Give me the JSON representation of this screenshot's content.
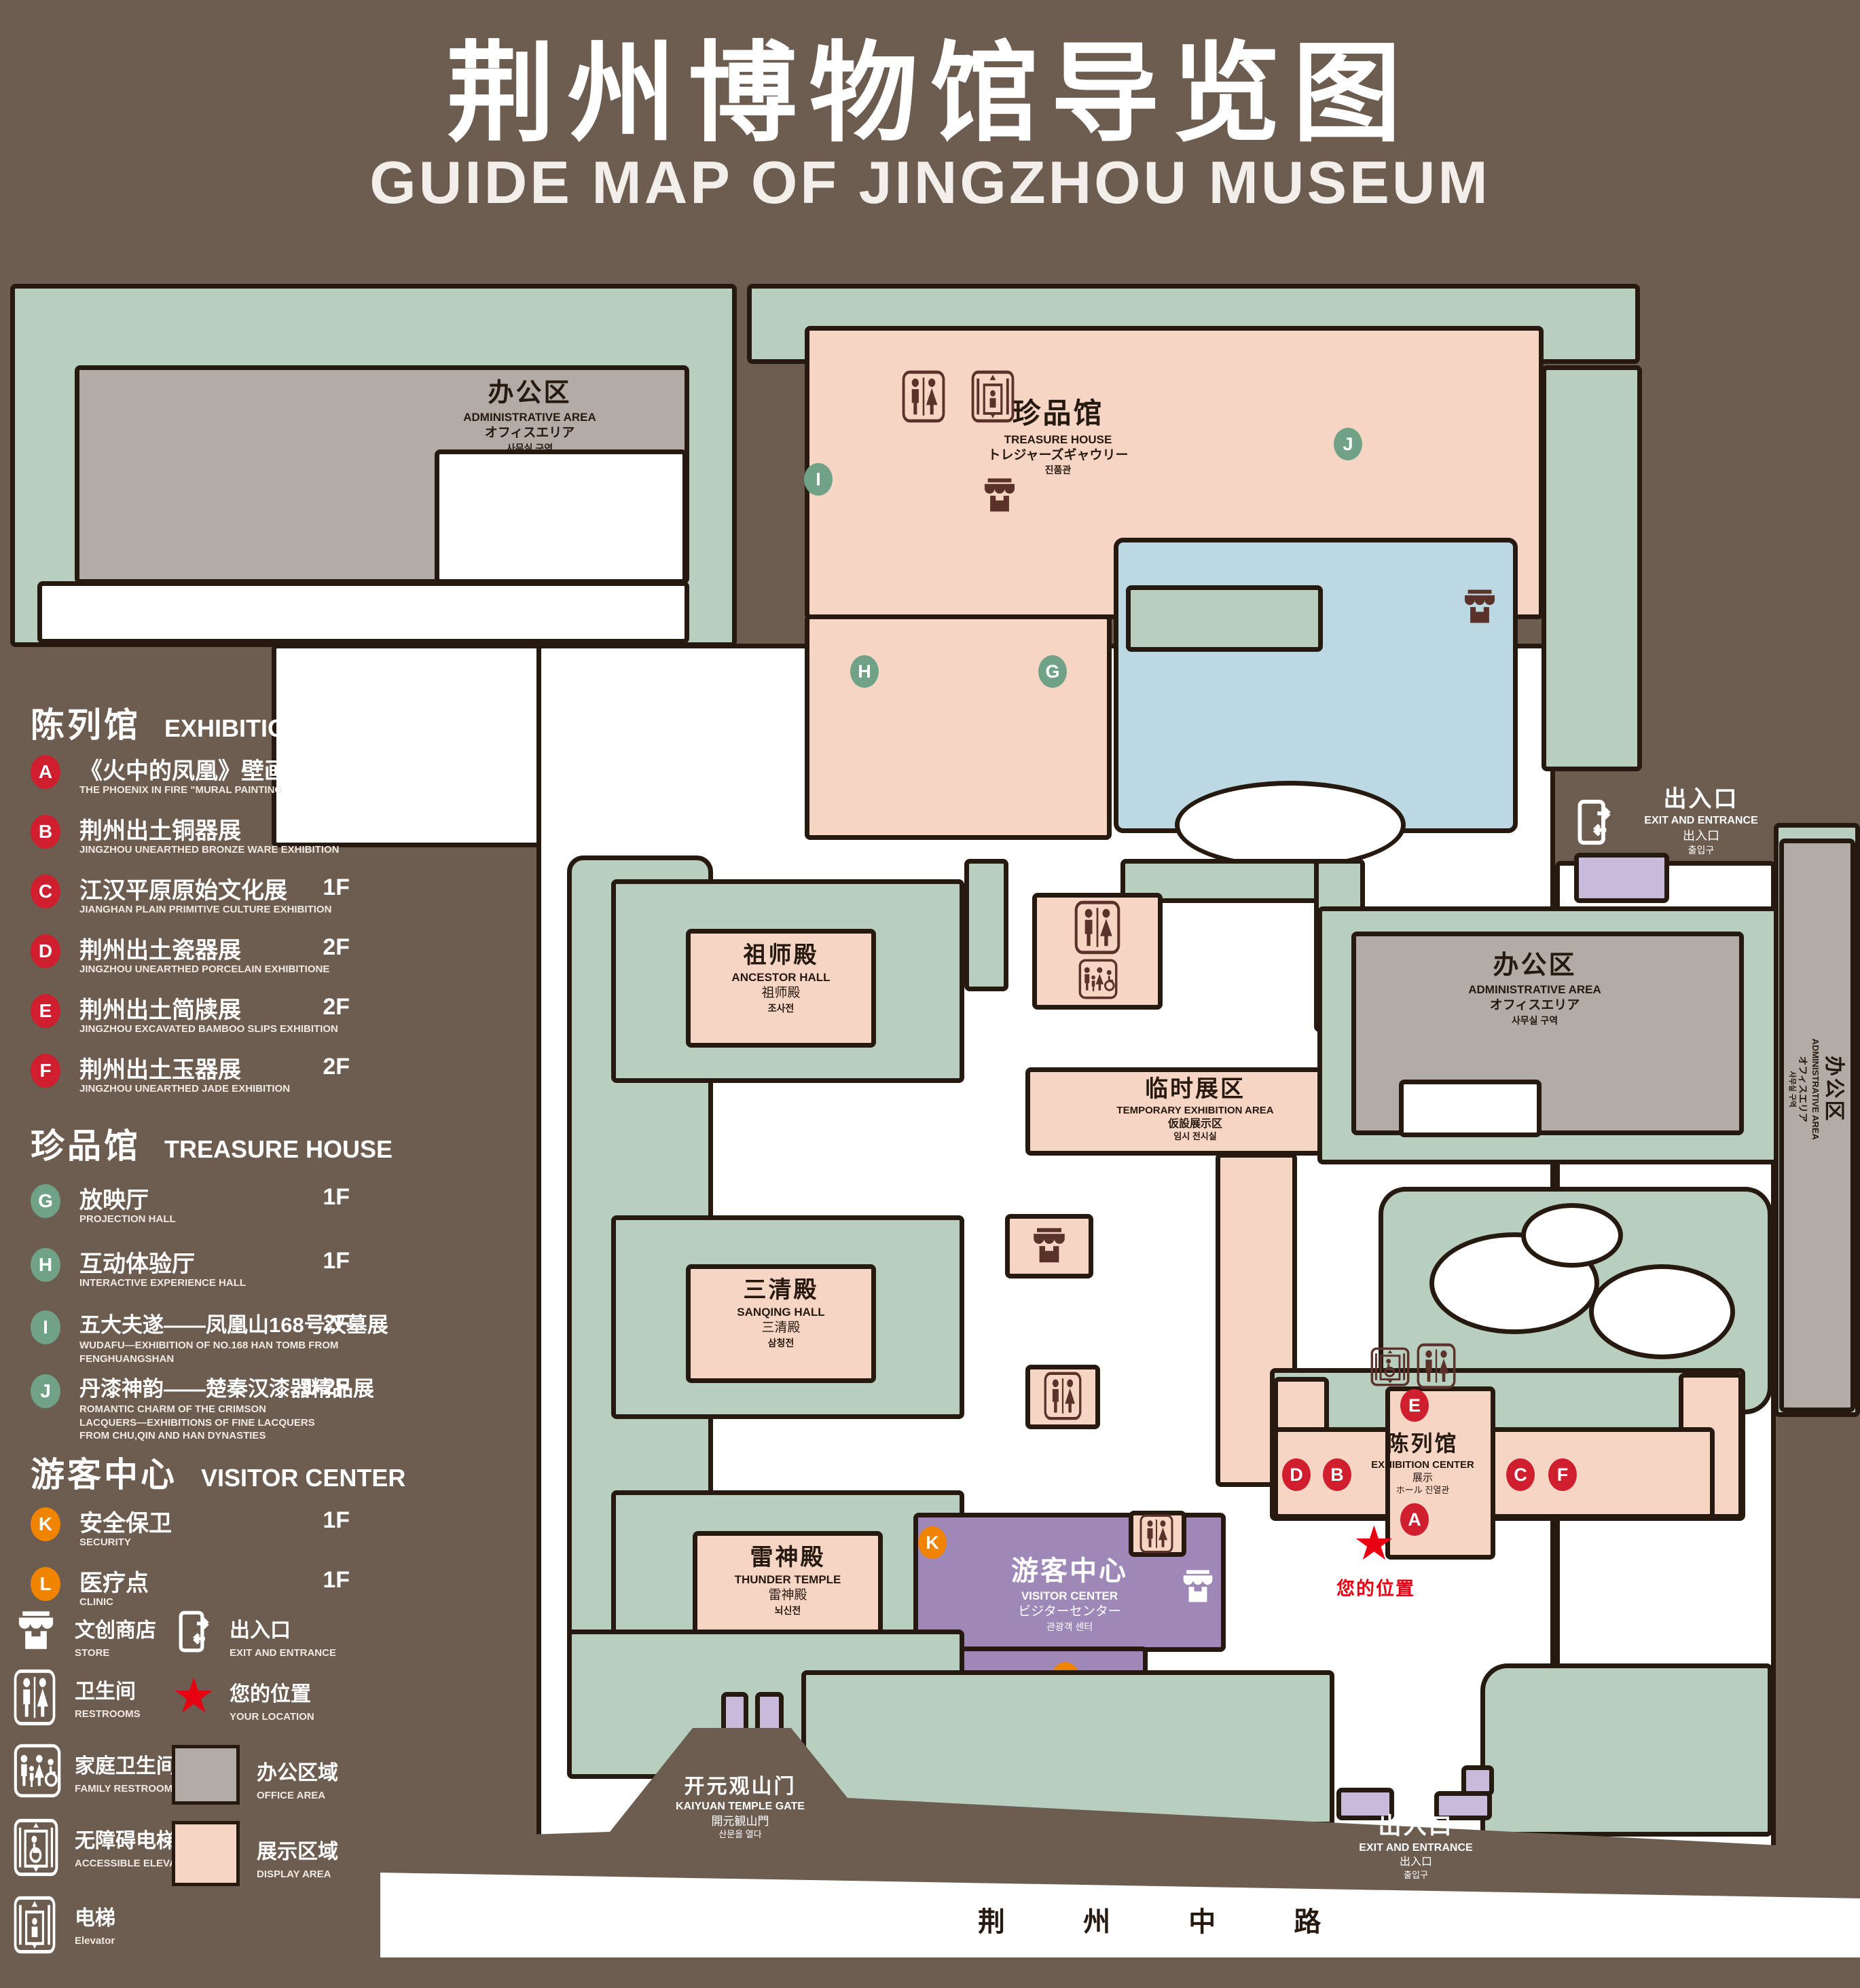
{
  "title": {
    "cn": "荆州博物馆导览图",
    "en": "GUIDE MAP OF JINGZHOU MUSEUM"
  },
  "legend": {
    "sections": [
      {
        "cn": "陈列馆",
        "en": "EXHIBITION CENTER",
        "items": [
          {
            "k": "A",
            "cn": "《火中的凤凰》壁画",
            "en": "THE PHOENIX IN FIRE \"MURAL PAINTING",
            "fl": "1F"
          },
          {
            "k": "B",
            "cn": "荆州出土铜器展",
            "en": "JINGZHOU UNEARTHED BRONZE WARE EXHIBITION",
            "fl": "1F"
          },
          {
            "k": "C",
            "cn": "江汉平原原始文化展",
            "en": "JIANGHAN PLAIN PRIMITIVE CULTURE EXHIBITION",
            "fl": "1F"
          },
          {
            "k": "D",
            "cn": "荆州出土瓷器展",
            "en": "JINGZHOU UNEARTHED PORCELAIN EXHIBITIONE",
            "fl": "2F"
          },
          {
            "k": "E",
            "cn": "荆州出土简牍展",
            "en": "JINGZHOU EXCAVATED BAMBOO SLIPS EXHIBITION",
            "fl": "2F"
          },
          {
            "k": "F",
            "cn": "荆州出土玉器展",
            "en": "JINGZHOU UNEARTHED JADE EXHIBITION",
            "fl": "2F"
          }
        ]
      },
      {
        "cn": "珍品馆",
        "en": "TREASURE HOUSE",
        "items": [
          {
            "k": "G",
            "cn": "放映厅",
            "en": "PROJECTION HALL",
            "fl": "1F"
          },
          {
            "k": "H",
            "cn": "互动体验厅",
            "en": "INTERACTIVE EXPERIENCE HALL",
            "fl": "1F"
          },
          {
            "k": "I",
            "cn": "五大夫遂——凤凰山168号汉墓展",
            "en": "WUDAFU—EXHIBITION OF NO.168 HAN TOMB FROM FENGHUANGSHAN",
            "fl": "2F"
          },
          {
            "k": "J",
            "cn": "丹漆神韵——楚秦汉漆器精品展",
            "en": "ROMANTIC CHARM OF THE CRIMSON LACQUERS—EXHIBITIONS OF FINE LACQUERS FROM CHU,QIN AND HAN DYNASTIES",
            "fl": "1-2F"
          }
        ]
      },
      {
        "cn": "游客中心",
        "en": "VISITOR CENTER",
        "items": [
          {
            "k": "K",
            "cn": "安全保卫",
            "en": "SECURITY",
            "fl": "1F"
          },
          {
            "k": "L",
            "cn": "医疗点",
            "en": "CLINIC",
            "fl": "1F"
          }
        ]
      }
    ],
    "symbols_left": [
      {
        "icon": "store-icon",
        "cn": "文创商店",
        "en": "STORE"
      },
      {
        "icon": "restrooms-icon",
        "cn": "卫生间",
        "en": "RESTROOMS"
      },
      {
        "icon": "family-restrooms-icon",
        "cn": "家庭卫生间",
        "en": "FAMILY RESTROOMS"
      },
      {
        "icon": "accessible-elevator-icon",
        "cn": "无障碍电梯",
        "en": "ACCESSIBLE ELEVATOR"
      },
      {
        "icon": "elevator-icon",
        "cn": "电梯",
        "en": "Elevator"
      }
    ],
    "symbols_right": [
      {
        "icon": "exit-icon",
        "cn": "出入口",
        "en": "EXIT AND ENTRANCE"
      },
      {
        "icon": "location-star",
        "cn": "您的位置",
        "en": "YOUR LOCATION"
      },
      {
        "swatch": "#b3aca6",
        "cn": "办公区域",
        "en": "OFFICE AREA"
      },
      {
        "swatch": "#f7d5c5",
        "cn": "展示区域",
        "en": "DISPLAY AREA"
      }
    ]
  },
  "map": {
    "b": {
      "admin": {
        "cn": "办公区",
        "en": "ADMINISTRATIVE AREA",
        "jp": "オフィスエリア",
        "kr": "사무실 구역"
      },
      "treasure": {
        "cn": "珍品馆",
        "en": "TREASURE HOUSE",
        "jp": "トレジャーズギャウリー",
        "kr": "진품관"
      },
      "ancestor": {
        "cn": "祖师殿",
        "en": "ANCESTOR HALL",
        "jp": "祖师殿",
        "kr": "조사전"
      },
      "temp": {
        "cn": "临时展区",
        "en": "TEMPORARY EXHIBITION AREA",
        "jp": "仮設展示区",
        "kr": "임시 전시실"
      },
      "sanqing": {
        "cn": "三清殿",
        "en": "SANQING HALL",
        "jp": "三清殿",
        "kr": "삼청전"
      },
      "thunder": {
        "cn": "雷神殿",
        "en": "THUNDER TEMPLE",
        "jp": "雷神殿",
        "kr": "뇌신전"
      },
      "visitor": {
        "cn": "游客中心",
        "en": "VISITOR CENTER",
        "jp": "ビジターセンター",
        "kr": "관광객 센터"
      },
      "exhib": {
        "cn": "陈列馆",
        "en": "EXHIBITION CENTER",
        "jp": "展示",
        "kr": "ホール 진열관"
      },
      "gate": {
        "cn": "开元观山门",
        "en": "KAIYUAN TEMPLE GATE",
        "jp": "開元観山門",
        "kr": "산문을 열다"
      },
      "exit": {
        "cn": "出入口",
        "en": "EXIT AND ENTRANCE",
        "jp": "出入口",
        "kr": "출입구"
      },
      "yourloc": {
        "cn": "您的位置"
      },
      "road": {
        "cn": "荆 州 中 路"
      }
    },
    "letters": {
      "A": "A",
      "B": "B",
      "C": "C",
      "D": "D",
      "E": "E",
      "F": "F",
      "G": "G",
      "H": "H",
      "I": "I",
      "J": "J",
      "K": "K",
      "L": "L"
    }
  },
  "colors": {
    "background": "#6d5c50",
    "green_area": "#b8cfc0",
    "display_area": "#f7d5c5",
    "office_area": "#b3aca6",
    "pond": "#bcd8e2",
    "visitor_purple": "#9d88b8",
    "marker_red": "#cf1e2e",
    "marker_green": "#6fa287",
    "marker_orange": "#f08300",
    "location_red": "#e60012"
  }
}
